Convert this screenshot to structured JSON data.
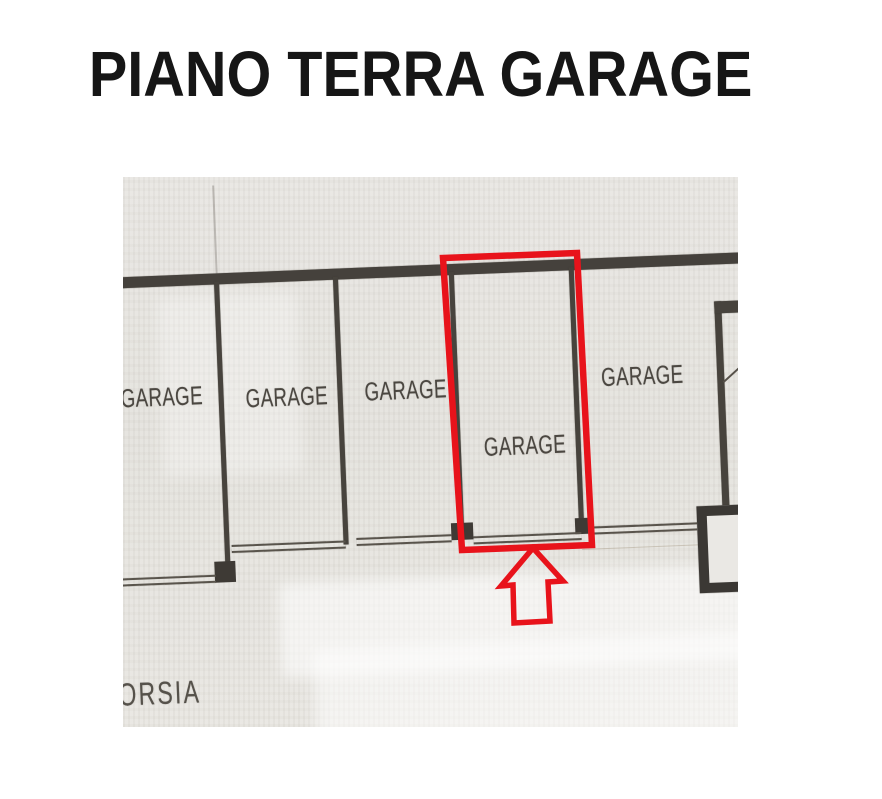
{
  "title": {
    "text": "PIANO TERRA GARAGE",
    "color": "#161616"
  },
  "floor_plan": {
    "room_labels": [
      "GARAGE",
      "GARAGE",
      "GARAGE",
      "GARAGE",
      "GARAGE"
    ],
    "corridor_label": "ORSIA",
    "colors": {
      "paper": "#e7e5e1",
      "ink": "#47433d",
      "highlight_red": "#e8131b"
    }
  },
  "highlight": {
    "shape": "rectangle",
    "arrow_icon": "up-arrow",
    "color": "#e8131b"
  }
}
